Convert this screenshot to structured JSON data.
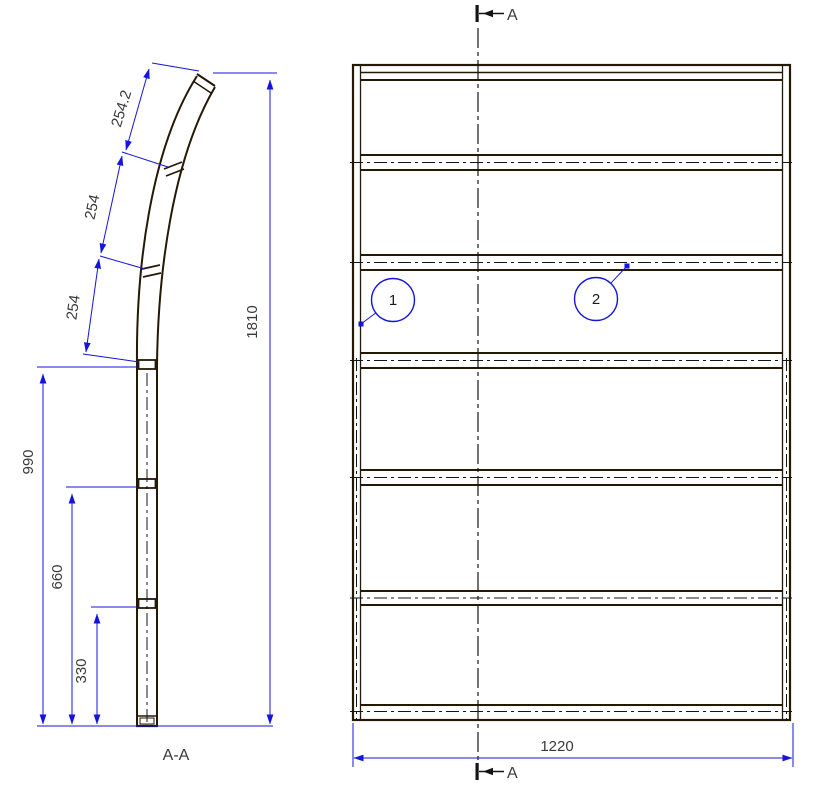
{
  "drawing": {
    "section_view": {
      "label": "A-A",
      "dim_254_2": "254.2",
      "dim_254_a": "254",
      "dim_254_b": "254",
      "dim_1810": "1810",
      "dim_990": "990",
      "dim_660": "660",
      "dim_330": "330"
    },
    "front_view": {
      "dim_width": "1220",
      "balloon_1": "1",
      "balloon_2": "2",
      "section_marker_top": "A",
      "section_marker_bottom": "A"
    },
    "colors": {
      "geometry_line": "#241807",
      "dimension_line": "#1414dd",
      "centerline": "#141414",
      "dimension_text": "#3a3a3a"
    }
  }
}
